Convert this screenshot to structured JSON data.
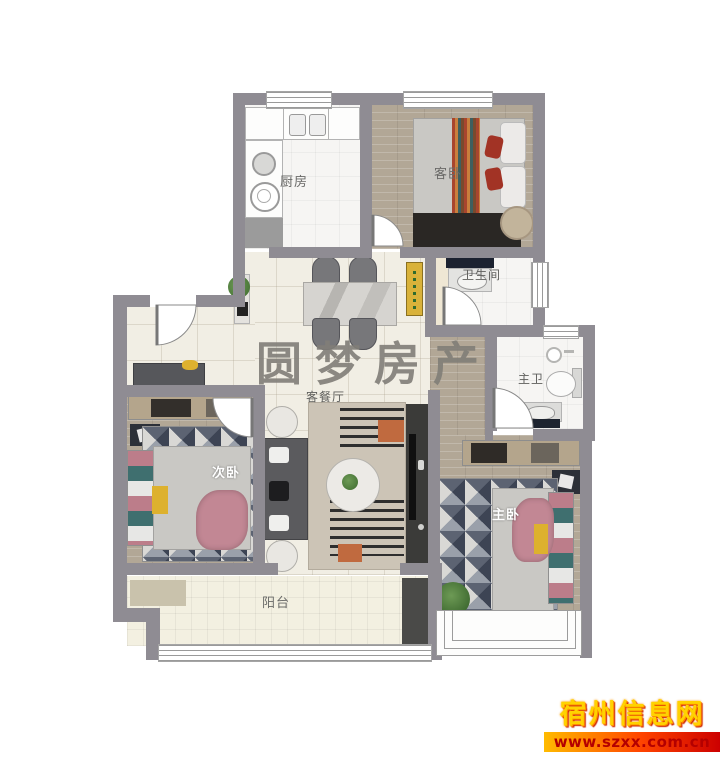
{
  "rooms": {
    "kitchen": "厨房",
    "guest_bedroom": "客卧",
    "bathroom": "卫生间",
    "master_bathroom": "主卫",
    "living_dining": "客餐厅",
    "second_bedroom": "次卧",
    "master_bedroom": "主卧",
    "balcony": "阳台"
  },
  "watermark": "圆梦房产",
  "branding": {
    "site_name": "宿州信息网",
    "site_url": "www.szxx.com.cn"
  },
  "colors": {
    "wall": "#8f8c93",
    "wood_floor": "#b2a796",
    "marble_floor": "#f1eee4",
    "balcony_floor": "#f3f0e1",
    "accent_yellow": "#ddb12e",
    "blanket_pink": "#c28794",
    "brand_gold": "#ffd200",
    "brand_red": "#cc0000"
  }
}
